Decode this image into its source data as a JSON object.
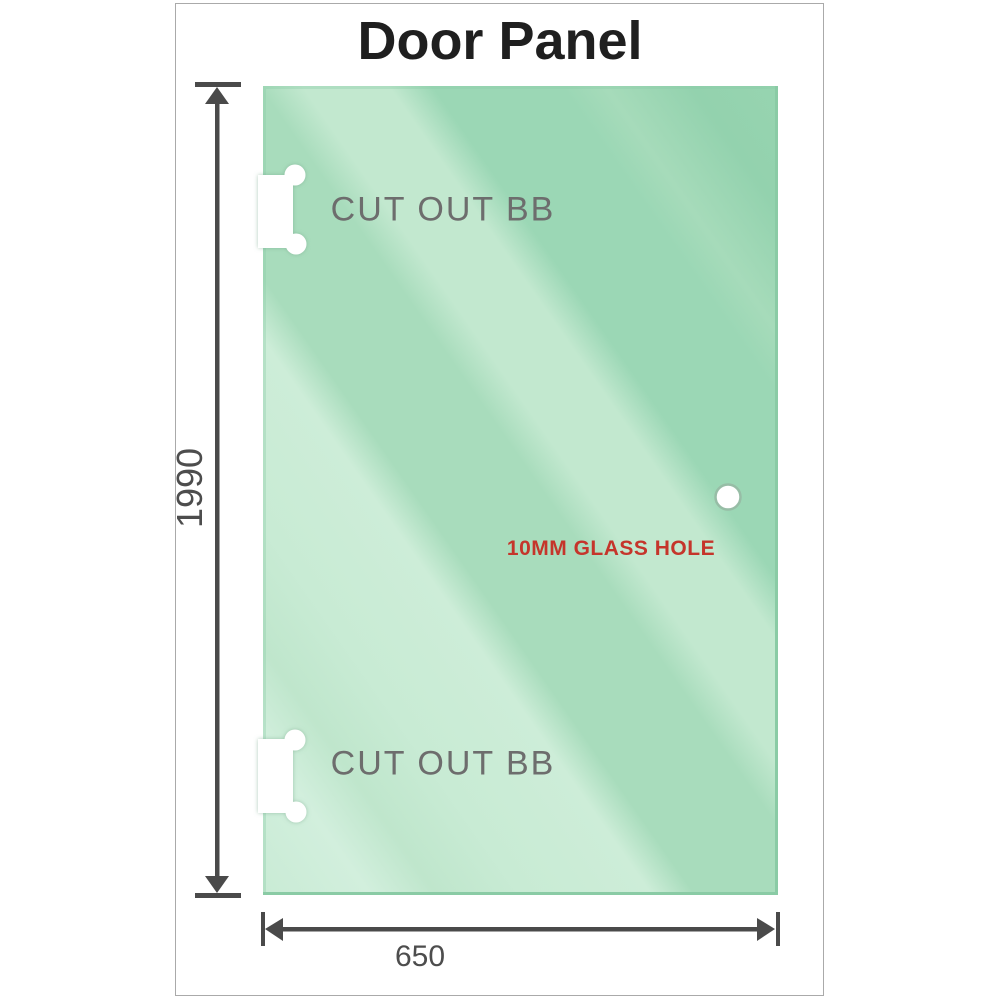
{
  "drawing": {
    "title": "Door Panel",
    "panel": {
      "cutouts": [
        {
          "label": "CUT OUT BB"
        },
        {
          "label": "CUT OUT BB"
        }
      ],
      "glass_hole": {
        "label": "10MM GLASS HOLE"
      }
    },
    "dimensions": {
      "height": "1990",
      "width": "650"
    }
  },
  "colors": {
    "glass_light": "#cdeeda",
    "glass_mid": "#b7e2c6",
    "glass_dark": "#9ad6b4",
    "glass_edge": "#8acba5",
    "dimension_lines": "#4a4a4a",
    "dimension_text": "#4d4d4d",
    "cutout_label_text": "#6d6d6d",
    "hole_label_text": "#c5352b",
    "frame_border": "#aaaaaa",
    "title_text": "#1f1f1f"
  }
}
